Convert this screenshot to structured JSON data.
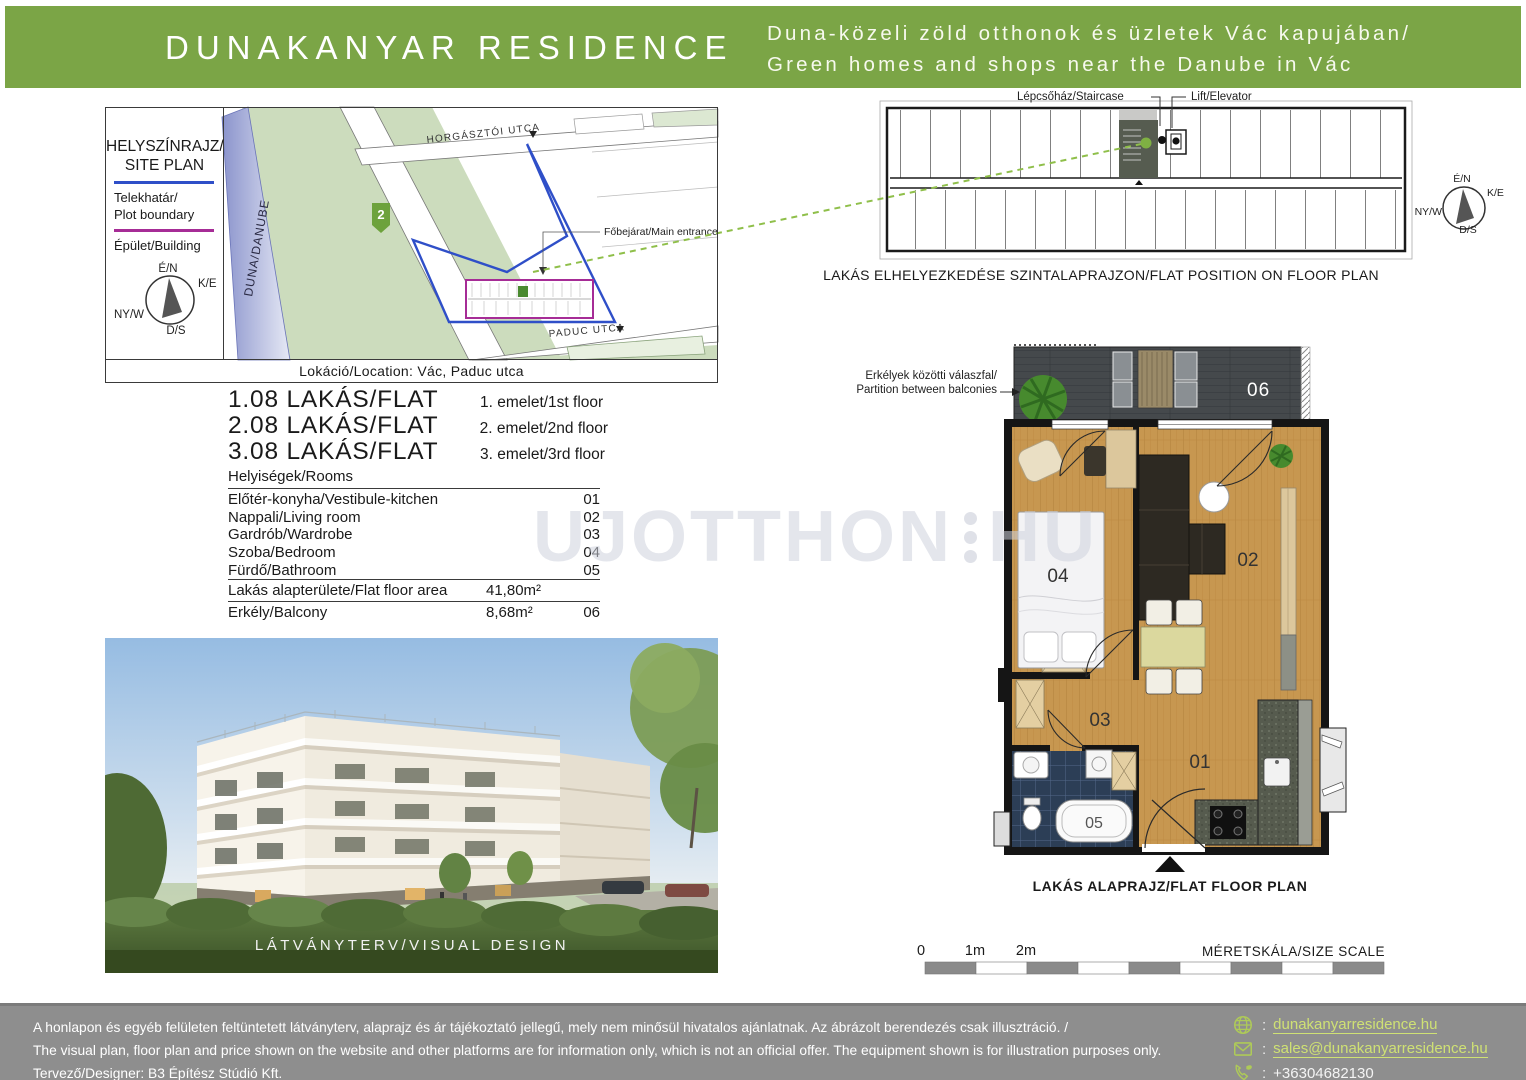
{
  "header": {
    "title": "DUNAKANYAR RESIDENCE",
    "tagline_hu": "Duna-közeli zöld otthonok és üzletek Vác kapujában/",
    "tagline_en": "Green homes and shops near the Danube in Vác"
  },
  "site_plan": {
    "title_hu": "HELYSZÍNRAJZ/",
    "title_en": "SITE PLAN",
    "legend_plot_hu": "Telekhatár/",
    "legend_plot_en": "Plot boundary",
    "legend_building": "Épület/Building",
    "street_top": "HORGÁSZTÓI UTCA",
    "street_bottom": "PADUC UTCA",
    "river": "DUNA/DANUBE",
    "route_number": "2",
    "entrance_label": "Főbejárat/Main entrance",
    "location": "Lokáció/Location: Vác, Paduc utca"
  },
  "compass": {
    "n": "É/N",
    "e": "K/E",
    "w": "NY/W",
    "s": "D/S"
  },
  "flats": {
    "rows": [
      {
        "name": "1.08 LAKÁS/FLAT",
        "floor": "1. emelet/1st floor"
      },
      {
        "name": "2.08 LAKÁS/FLAT",
        "floor": "2. emelet/2nd floor"
      },
      {
        "name": "3.08 LAKÁS/FLAT",
        "floor": "3. emelet/3rd floor"
      }
    ]
  },
  "rooms": {
    "header": "Helyiségek/Rooms",
    "items": [
      {
        "label": "Előtér-konyha/Vestibule-kitchen",
        "code": "01"
      },
      {
        "label": "Nappali/Living room",
        "code": "02"
      },
      {
        "label": "Gardrób/Wardrobe",
        "code": "03"
      },
      {
        "label": "Szoba/Bedroom",
        "code": "04"
      },
      {
        "label": "Fürdő/Bathroom",
        "code": "05"
      }
    ],
    "floor_area_label": "Lakás alapterülete/Flat floor area",
    "floor_area_value": "41,80m²",
    "balcony_label": "Erkély/Balcony",
    "balcony_value": "8,68m²",
    "balcony_code": "06"
  },
  "watermark": {
    "left": "UJOTTHON",
    "right": "HU"
  },
  "visual": {
    "caption": "LÁTVÁNYTERV/VISUAL DESIGN"
  },
  "strip": {
    "staircase": "Lépcsőház/Staircase",
    "lift": "Lift/Elevator",
    "caption": "LAKÁS ELHELYEZKEDÉSE SZINTALAPRAJZON/FLAT POSITION ON FLOOR PLAN"
  },
  "flat_plan": {
    "partition_hu": "Erkélyek közötti válaszfal/",
    "partition_en": "Partition between balconies",
    "caption": "LAKÁS ALAPRAJZ/FLAT FLOOR PLAN",
    "labels": {
      "r01": "01",
      "r02": "02",
      "r03": "03",
      "r04": "04",
      "r05": "05",
      "r06": "06"
    }
  },
  "scale": {
    "t0": "0",
    "t1": "1m",
    "t2": "2m",
    "caption": "MÉRETSKÁLA/SIZE SCALE"
  },
  "footer": {
    "disclaimer_hu": "A honlapon és egyéb felületen feltüntetett látványterv, alaprajz és ár tájékoztató jellegű, mely nem minősül hivatalos ajánlatnak. Az ábrázolt berendezés csak illusztráció. /",
    "disclaimer_en": "The visual plan, floor plan and price shown on the website and other platforms are for information only, which is not an official offer. The equipment shown is for illustration purposes only.",
    "designer": "Tervező/Designer: B3 Építész Stúdió Kft.",
    "sep": ":",
    "website": "dunakanyarresidence.hu",
    "email": "sales@dunakanyarresidence.hu",
    "phone": "+36304682130"
  },
  "colors": {
    "brand_green": "#7ba546",
    "footer_gray": "#8e8e8e",
    "link_green": "#cfe174",
    "plot_blue": "#2f4fc8",
    "building_magenta": "#a62c96",
    "dashed_green": "#8fbf4a"
  }
}
